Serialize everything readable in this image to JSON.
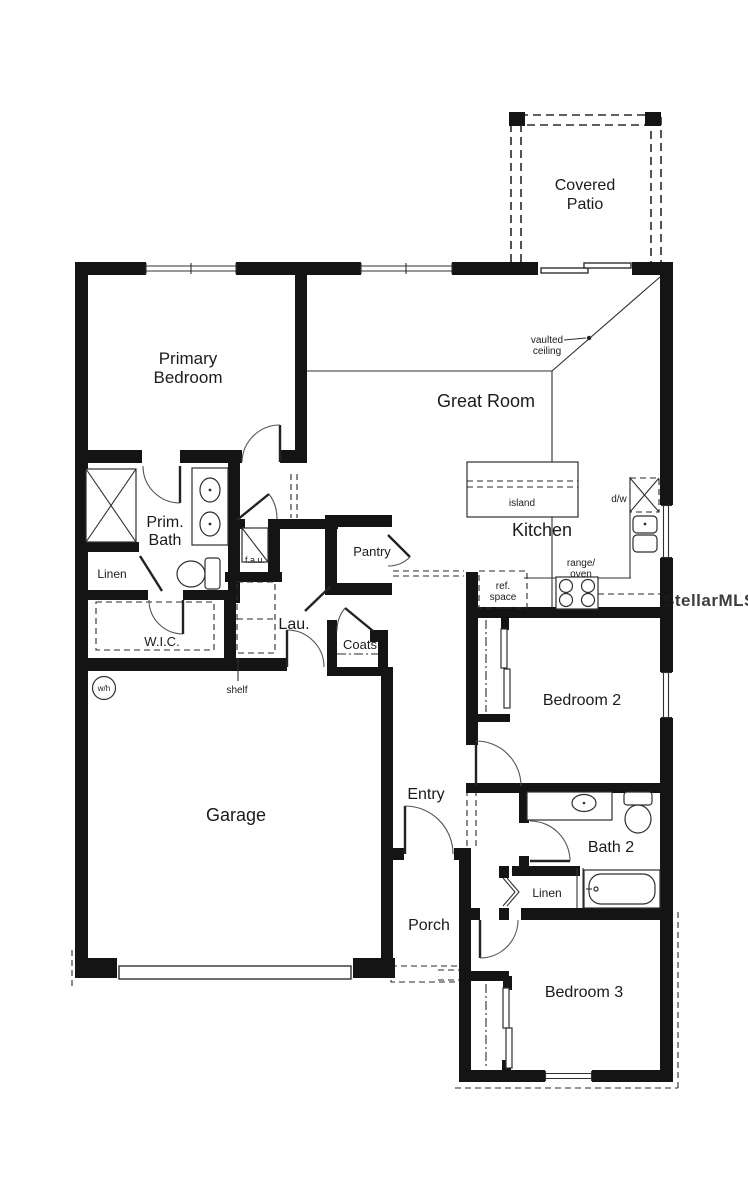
{
  "title": "Single-story floor plan",
  "watermark": "StellarMLS",
  "rooms": [
    {
      "id": "covered-patio",
      "lines": [
        "Covered",
        "Patio"
      ]
    },
    {
      "id": "primary-bedroom",
      "lines": [
        "Primary",
        "Bedroom"
      ]
    },
    {
      "id": "great-room",
      "lines": [
        "Great Room"
      ]
    },
    {
      "id": "kitchen",
      "lines": [
        "Kitchen"
      ]
    },
    {
      "id": "prim-bath",
      "lines": [
        "Prim.",
        "Bath"
      ]
    },
    {
      "id": "linen-primary",
      "lines": [
        "Linen"
      ]
    },
    {
      "id": "wic",
      "lines": [
        "W.I.C."
      ]
    },
    {
      "id": "laundry",
      "lines": [
        "Lau."
      ]
    },
    {
      "id": "pantry",
      "lines": [
        "Pantry"
      ]
    },
    {
      "id": "coats",
      "lines": [
        "Coats"
      ]
    },
    {
      "id": "garage",
      "lines": [
        "Garage"
      ]
    },
    {
      "id": "entry",
      "lines": [
        "Entry"
      ]
    },
    {
      "id": "porch",
      "lines": [
        "Porch"
      ]
    },
    {
      "id": "bedroom-2",
      "lines": [
        "Bedroom 2"
      ]
    },
    {
      "id": "bath-2",
      "lines": [
        "Bath 2"
      ]
    },
    {
      "id": "linen-bath2",
      "lines": [
        "Linen"
      ]
    },
    {
      "id": "bedroom-3",
      "lines": [
        "Bedroom 3"
      ]
    }
  ],
  "annotations": [
    {
      "id": "vaulted-ceiling",
      "lines": [
        "vaulted",
        "ceiling"
      ]
    },
    {
      "id": "island",
      "lines": [
        "island"
      ]
    },
    {
      "id": "dishwasher",
      "lines": [
        "d/w"
      ]
    },
    {
      "id": "range-oven",
      "lines": [
        "range/",
        "oven"
      ]
    },
    {
      "id": "ref-space",
      "lines": [
        "ref.",
        "space"
      ]
    },
    {
      "id": "fau",
      "lines": [
        "f.a.u."
      ]
    },
    {
      "id": "shelf",
      "lines": [
        "shelf"
      ]
    },
    {
      "id": "water-heater",
      "lines": [
        "w/h"
      ]
    }
  ],
  "colors": {
    "wall": "#141414",
    "line": "#303030",
    "text": "#1b1b1b",
    "watermark": "#c6c6c6",
    "background": "#ffffff"
  }
}
